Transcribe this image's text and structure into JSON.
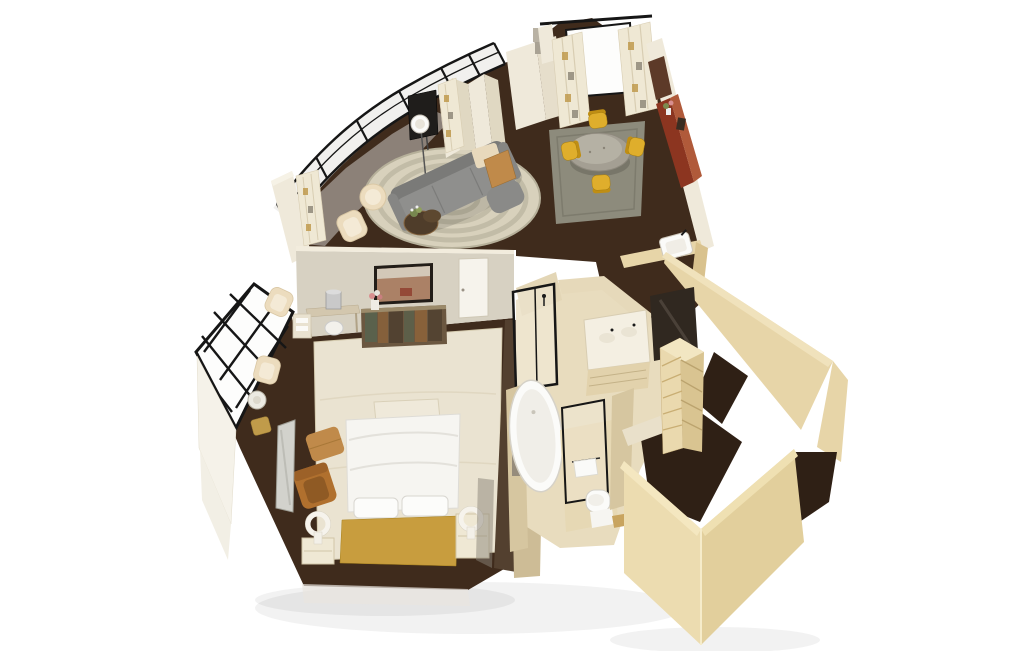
{
  "image": {
    "kind": "3d-isometric-floor-plan-rendering",
    "subject": "hotel suite cutaway floor plan, bird's-eye view",
    "background": "#ffffff"
  },
  "palette": {
    "bg": "#ffffff",
    "frame_black": "#161616",
    "glass_white": "#fdfdfc",
    "wall_cream": "#efe9da",
    "wall_cream_edge": "#f6f2e6",
    "wall_greige": "#d7d1c2",
    "wall_greige_top": "#f2ecdd",
    "wall_wood": "#e7d5a8",
    "wall_wood_light": "#f0e2bc",
    "wall_wood_dark": "#d9c28e",
    "travertine": "#e8dcbe",
    "travertine_mid": "#e3d6b6",
    "travertine_dark": "#d6c6a0",
    "floor_dark": "#3f2b1c",
    "floor_closet": "#2f2015",
    "floor_taupe": "#9a9088",
    "rug_living": "#d8d1bc",
    "rug_living_stripe": "#a29e88",
    "rug_dining": "#8d8b7c",
    "rug_bedroom": "#eae3d1",
    "sofa_gray": "#8f8f8d",
    "sofa_gray_dark": "#7a7a78",
    "chair_cream": "#ecdcbe",
    "chair_yellow": "#dfae2c",
    "chair_yellow_dark": "#bf8e14",
    "caramel": "#b0702e",
    "caramel_light": "#c08a4a",
    "credenza_red": "#8c3520",
    "credenza_red_top": "#b05a3a",
    "stone_table": "#a49f93",
    "stone_table_light": "#b9b4a7",
    "bed_white": "#f6f5f1",
    "bed_gold": "#c89d3e",
    "dresser_patina": "#6b5740",
    "patina_teal": "#4d6a55",
    "patina_copper": "#a06a35",
    "fixture_white": "#fbfbf9",
    "mirror_dark": "#302820",
    "wood_mid": "#53402f",
    "metal_gray": "#c9c9c9",
    "shadow": "#000000"
  },
  "rooms": {
    "living_room": {
      "label": "Living room",
      "items": [
        "curved window wall",
        "sofa",
        "two cream armchairs",
        "coffee table with plant",
        "floor lamp",
        "TV on stand",
        "console bench",
        "round area rug",
        "folding screen with curtains"
      ]
    },
    "dining_area": {
      "label": "Dining area",
      "items": [
        "round stone dining table",
        "four yellow chairs",
        "gray area rug",
        "red credenza with flowers",
        "window with curtains"
      ]
    },
    "foyer": {
      "label": "Foyer",
      "items": [
        "powder room sink",
        "angled hall wall"
      ]
    },
    "bedroom": {
      "label": "Bedroom",
      "items": [
        "king bed",
        "gold headboard",
        "foot bench",
        "two nightstands",
        "two ring lamps",
        "leather armchair",
        "ottoman",
        "wall TV",
        "patina dresser",
        "desk with stool",
        "floor mirror",
        "two window chairs",
        "round side table",
        "lattice window wall",
        "area rug"
      ]
    },
    "bathroom": {
      "label": "Bathroom",
      "items": [
        "freestanding bathtub",
        "double vanity",
        "dark mirror",
        "walk-in shower"
      ]
    },
    "water_closet": {
      "label": "Water closet",
      "items": [
        "toilet",
        "towel rail",
        "glass door"
      ]
    },
    "walk_in_closet": {
      "label": "Walk-in closet",
      "items": [
        "shelving unit",
        "tall wardrobe walls"
      ]
    }
  }
}
